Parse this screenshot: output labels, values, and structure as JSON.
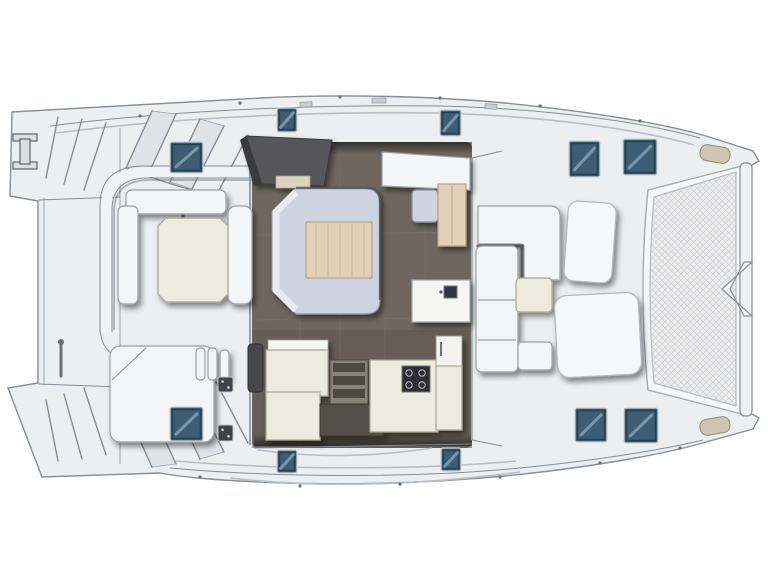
{
  "diagram": {
    "type": "boat-floor-plan",
    "subject": "sailing catamaran deck and saloon layout, top view, bow to the right",
    "orientation": "bow-right-stern-left",
    "areas": [
      {
        "id": "stern-platform",
        "label": "stern platform with transom steps"
      },
      {
        "id": "aft-cockpit",
        "label": "aft cockpit with U-shaped bench and table"
      },
      {
        "id": "saloon",
        "label": "saloon with dinette sofa and wood table"
      },
      {
        "id": "galley",
        "label": "galley with stove, sink and companionway steps"
      },
      {
        "id": "nav-counter",
        "label": "forward counter with sink"
      },
      {
        "id": "forward-cockpit",
        "label": "forward cockpit L-bench and table"
      },
      {
        "id": "foredeck-lounge",
        "label": "foredeck sunpads"
      },
      {
        "id": "trampoline",
        "label": "bow trampoline net with crossbeam and bowsprit"
      }
    ]
  },
  "colors": {
    "page-bg": "#ffffff",
    "deck": "#eceef0",
    "deck-shade": "#dfe2e6",
    "outline": "#888f96",
    "dark-line": "#3c4045",
    "saloon-floor": "#6f675f",
    "galley-floor": "#5e564e",
    "sofa": "#ced3e0",
    "sofa-highlight": "#e7eaf1",
    "table-wood": "#e2d1b8",
    "table-wood-line": "#c9b697",
    "cream": "#edebdd",
    "cream-stroke": "#a9a595",
    "white-furniture": "#f4f5f6",
    "hatch-blue": "#3c5d74",
    "hatch-blue-dark": "#24404f",
    "hatch-streak": "#8fabbc",
    "structure-dark": "#57575a",
    "structure-darker": "#3a3a3d",
    "mesh-line": "#c2c4c7",
    "mesh-bg": "#ededee",
    "stove-dark": "#2e2e30",
    "cleat-beige": "#cdc5b2"
  },
  "hatches": [
    {
      "name": "aft-port-coachroof-hatch",
      "x": 170,
      "y": 142,
      "w": 33,
      "h": 31
    },
    {
      "name": "coachroof-port-hatch",
      "x": 277,
      "y": 108,
      "w": 20,
      "h": 24
    },
    {
      "name": "coachroof-port-fwd-hatch",
      "x": 440,
      "y": 110,
      "w": 21,
      "h": 26
    },
    {
      "name": "foredeck-port-hatch-inner",
      "x": 569,
      "y": 141,
      "w": 31,
      "h": 36
    },
    {
      "name": "foredeck-port-hatch-outer",
      "x": 623,
      "y": 139,
      "w": 34,
      "h": 36
    },
    {
      "name": "cockpit-sole-hatch",
      "x": 170,
      "y": 407,
      "w": 33,
      "h": 34
    },
    {
      "name": "coachroof-stbd-hatch",
      "x": 277,
      "y": 450,
      "w": 20,
      "h": 23
    },
    {
      "name": "coachroof-stbd-fwd-hatch",
      "x": 441,
      "y": 448,
      "w": 20,
      "h": 23
    },
    {
      "name": "foredeck-stbd-hatch-inner",
      "x": 575,
      "y": 408,
      "w": 32,
      "h": 34
    },
    {
      "name": "foredeck-stbd-hatch-outer",
      "x": 624,
      "y": 408,
      "w": 34,
      "h": 35
    }
  ],
  "fittings": [
    {
      "name": "deck-fitting",
      "x": 218,
      "y": 377,
      "w": 15,
      "h": 15
    },
    {
      "name": "deck-fitting",
      "x": 218,
      "y": 425,
      "w": 15,
      "h": 16
    }
  ]
}
